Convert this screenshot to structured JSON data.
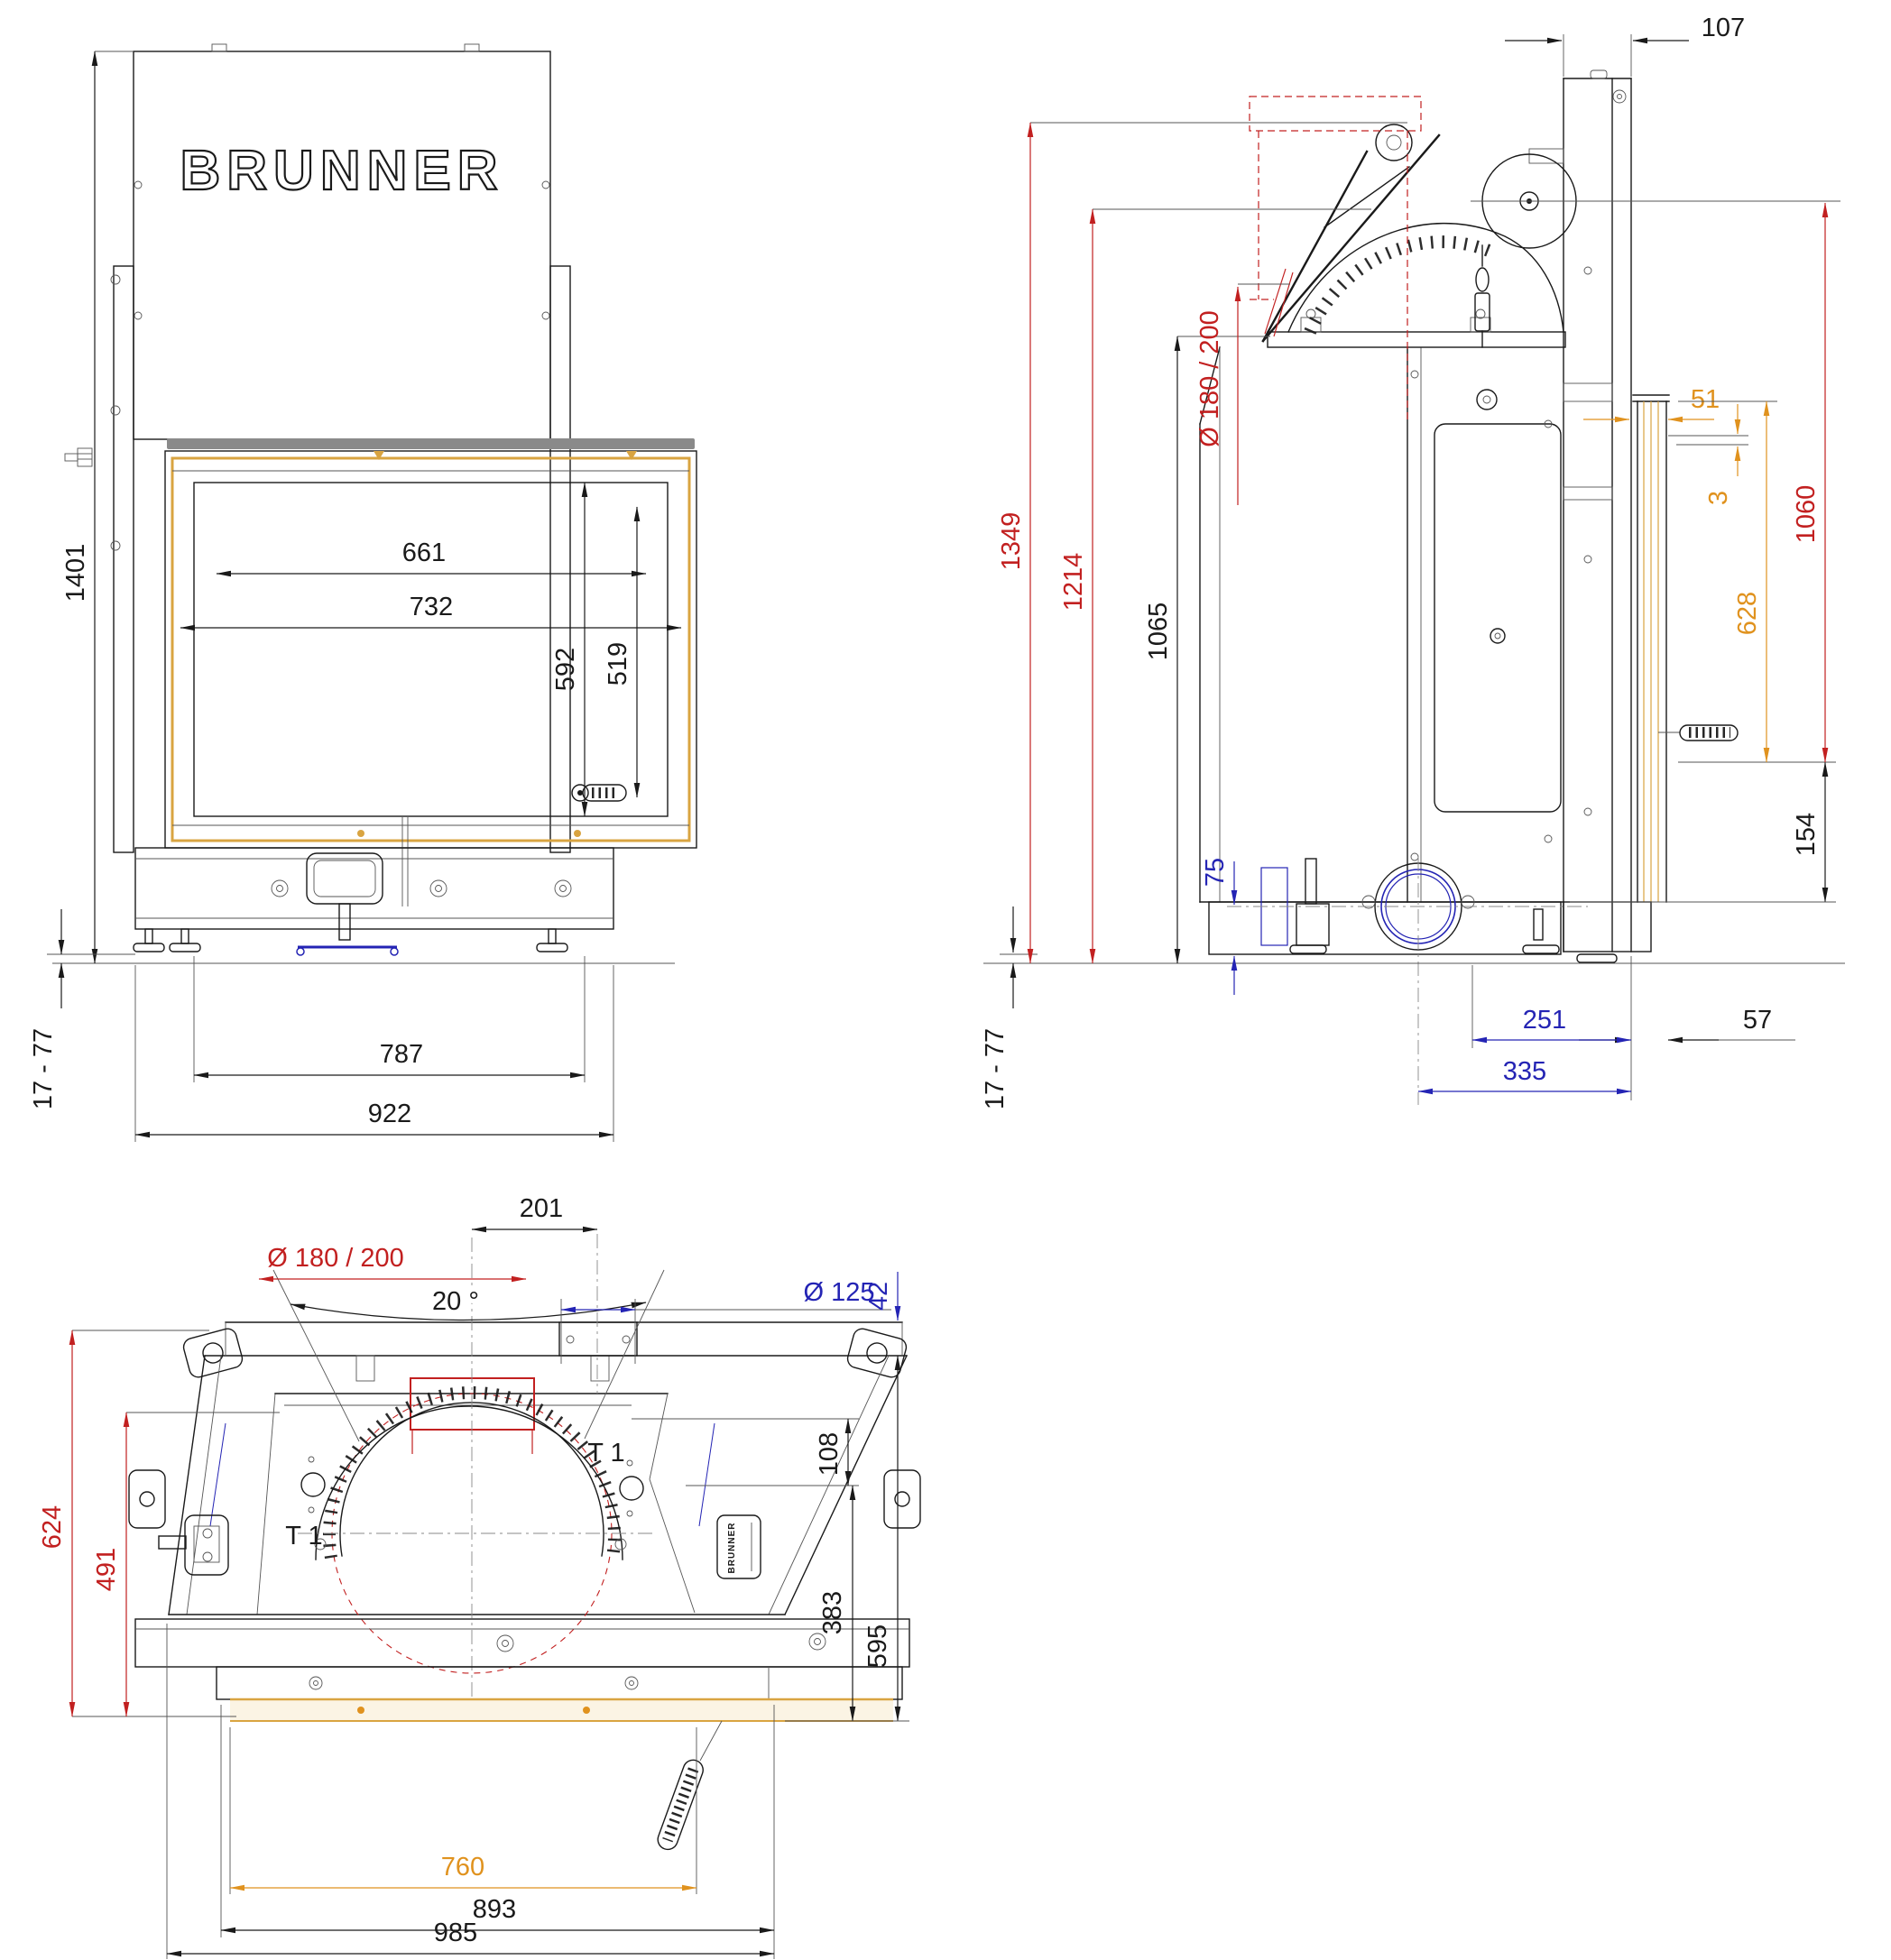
{
  "meta": {
    "brand": "BRUNNER",
    "drawing": "fireplace insert lift-door technical drawing, three orthographic views"
  },
  "colors": {
    "black": "#1a1a1a",
    "red": "#c22020",
    "orange": "#e0921e",
    "blue": "#2424b4",
    "tan": "#d9a441",
    "cream": "#fbf4e4",
    "gray_rail": "#8a8a8a",
    "line_gray": "#555555"
  },
  "views": {
    "front": {
      "title": "front view",
      "dims": {
        "total_height": "1401",
        "glass_width_inner": "661",
        "glass_width_outer": "732",
        "glass_height_outer": "592",
        "glass_height_inner": "519",
        "floor_gap": "17  -  77",
        "anchor_span": "787",
        "base_width": "922"
      }
    },
    "side": {
      "title": "side view",
      "dims": {
        "top_depth": "107",
        "height_max": "1349",
        "height_damper": "1214",
        "height_body": "1065",
        "flue_diameter": "Ø  180  /  200",
        "front_offset": "51",
        "glass_gap": "3",
        "height_front": "1060",
        "glass_height": "628",
        "base_height": "154",
        "outlet_height": "75",
        "outlet_to_front": "251",
        "front_lip": "57",
        "outlet_center_to_front": "335",
        "floor_gap": "17  -  77"
      }
    },
    "top": {
      "title": "top view",
      "labels": {
        "t1": "T 1"
      },
      "dims": {
        "flue_offset": "201",
        "flue_diameter": "Ø  180  /  200",
        "side_angle": "20  °",
        "port_diameter": "Ø  125",
        "back_gap": "42",
        "duct_depth": "108",
        "body_depth": "595",
        "front_depth": "383",
        "total_depth": "624",
        "inner_depth": "491",
        "glass_width": "760",
        "frame_width": "893",
        "total_width": "985"
      }
    }
  }
}
